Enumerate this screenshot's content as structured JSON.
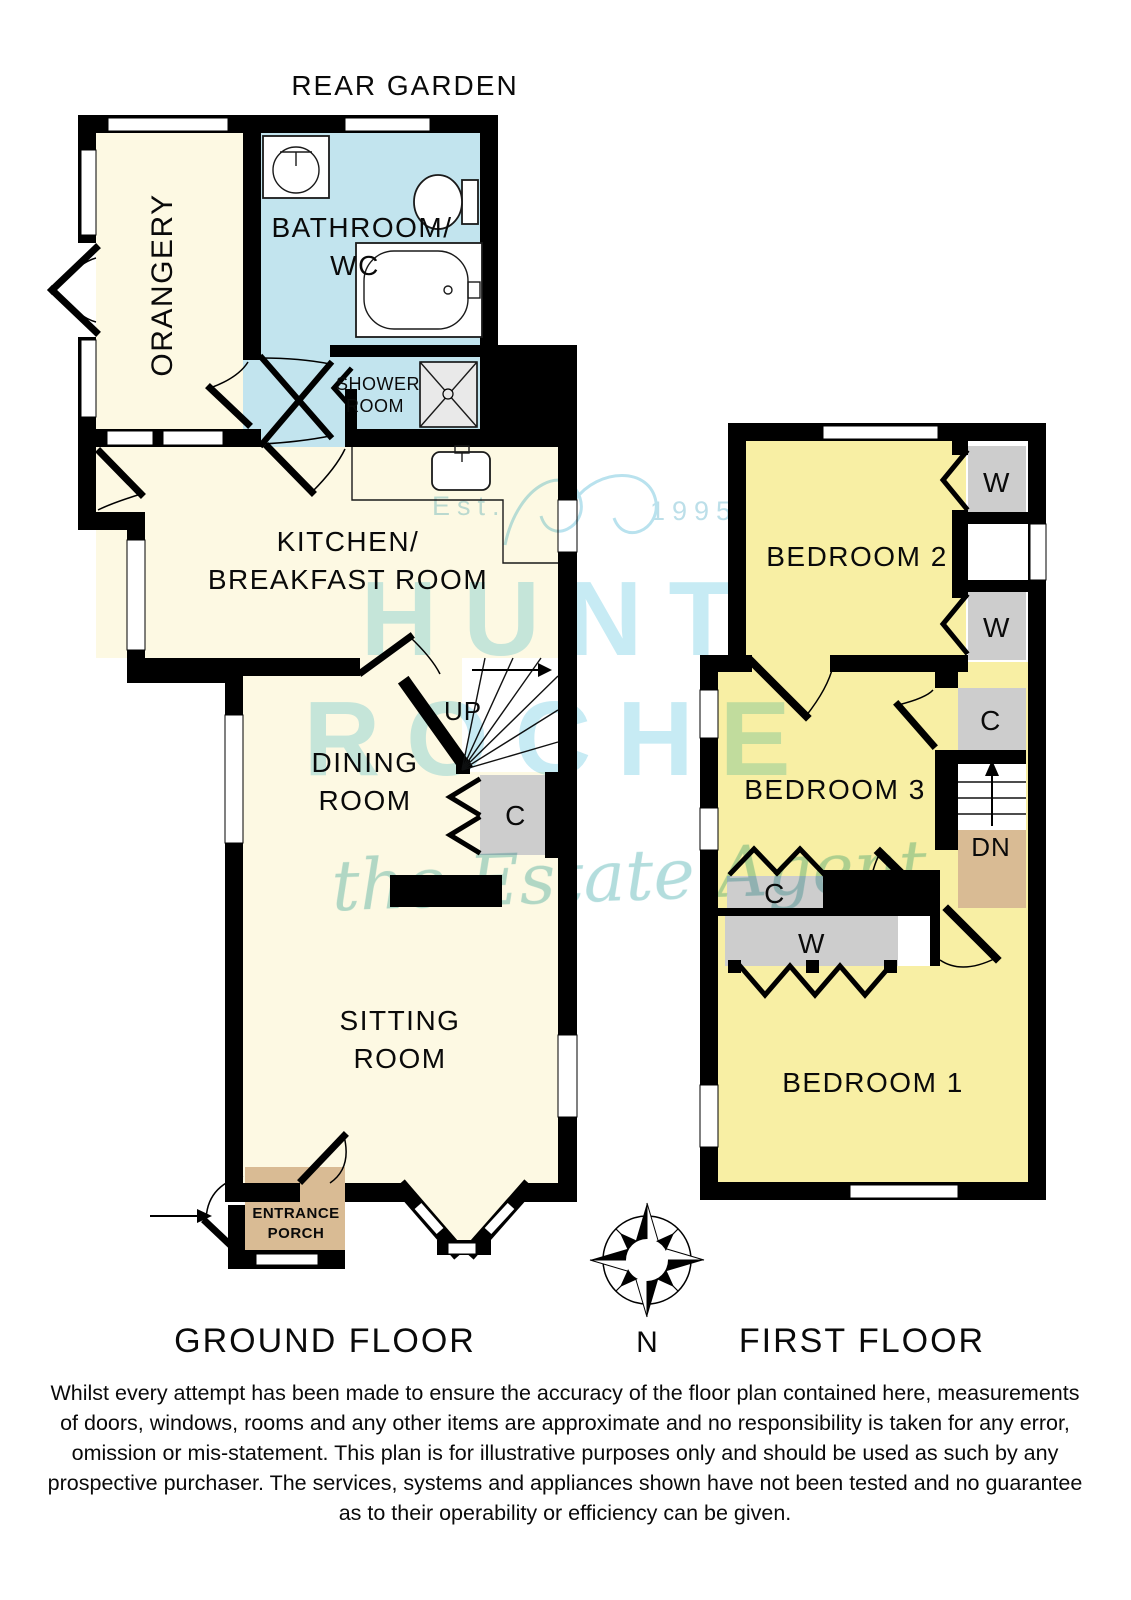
{
  "header": {
    "rear_garden": "REAR GARDEN"
  },
  "ground_floor": {
    "label": "GROUND FLOOR",
    "rooms": {
      "orangery": "ORANGERY",
      "bathroom_line1": "BATHROOM/",
      "bathroom_line2": "WC",
      "shower_line1": "SHOWER",
      "shower_line2": "ROOM",
      "kitchen_line1": "KITCHEN/",
      "kitchen_line2": "BREAKFAST ROOM",
      "dining_line1": "DINING",
      "dining_line2": "ROOM",
      "sitting_line1": "SITTING",
      "sitting_line2": "ROOM",
      "porch_line1": "ENTRANCE",
      "porch_line2": "PORCH",
      "stairs_up": "UP",
      "cupboard": "C"
    }
  },
  "first_floor": {
    "label": "FIRST FLOOR",
    "rooms": {
      "bedroom2": "BEDROOM 2",
      "bedroom3": "BEDROOM 3",
      "bedroom1": "BEDROOM 1",
      "wardrobe_top1": "W",
      "wardrobe_top2": "W",
      "cupboard_landing": "C",
      "stairs_down": "DN",
      "cupboard_mid": "C",
      "wardrobe_mid": "W"
    }
  },
  "compass": {
    "north": "N"
  },
  "watermark": {
    "est": "Est.",
    "year": "1995",
    "brand_line1": "HUNT",
    "brand_line2": "ROCHE",
    "tagline": "the Estate Agent"
  },
  "disclaimer": {
    "lines": [
      "Whilst every attempt has been made to ensure the accuracy of the floor plan contained here, measurements",
      "of doors, windows, rooms and any other items are approximate and no responsibility is taken for any error,",
      "omission or mis-statement. This plan is for illustrative purposes only and should be used as such by any",
      "prospective purchaser. The services, systems and appliances shown have not been tested and no guarantee",
      "as to their operability or efficiency can be given."
    ]
  },
  "colors": {
    "room_cream": "#fdf9e3",
    "room_blue": "#c2e4ee",
    "room_yellow": "#f8efa4",
    "room_tan": "#d9bb94",
    "closet_gray": "#cdcdcd",
    "wall_black": "#000000",
    "watermark_blue": "#c7ebf4",
    "watermark_teal": "#a6d8d8",
    "watermark_pale": "#bcdfe9"
  }
}
